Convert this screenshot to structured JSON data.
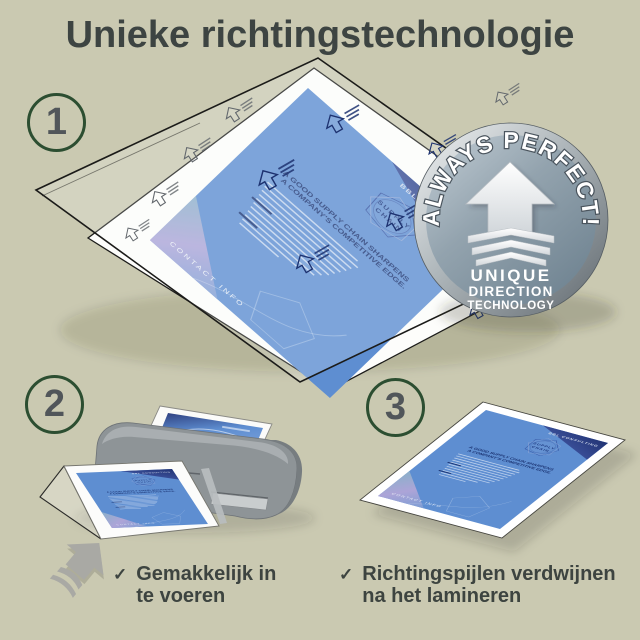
{
  "page": {
    "title": "Unieke richtingstechnologie"
  },
  "steps": {
    "step1": "1",
    "step2": "2",
    "step3": "3"
  },
  "badge": {
    "arc_text": "ALWAYS PERFECT!",
    "line1": "UNIQUE",
    "line2": "DIRECTION",
    "line3": "TECHNOLOGY"
  },
  "flyer": {
    "brand": "BBL CONSULTING",
    "logo_line1": "SUPPLY",
    "logo_line2": "CHAIN",
    "headline_line1": "A GOOD SUPPLY CHAIN SHARPENS",
    "headline_line2": "A COMPANY'S COMPETITIVE EDGE.",
    "footer": "CONTACT INFO"
  },
  "checklist": {
    "check_glyph": "✓",
    "item1_line1": "Gemakkelijk in",
    "item1_line2": "te voeren",
    "item2_line1": "Richtingspijlen verdwijnen",
    "item2_line2": "na het lamineren"
  },
  "colors": {
    "background": "#cac9b1",
    "heading_text": "#3d4442",
    "circle_border": "#2c4e31",
    "circle_number": "#51565a",
    "flyer_blue": "#5e8ed1",
    "flyer_navy": "#263a7d",
    "badge_face": "#93a3ae",
    "laminator_gray": "#8e9497"
  }
}
